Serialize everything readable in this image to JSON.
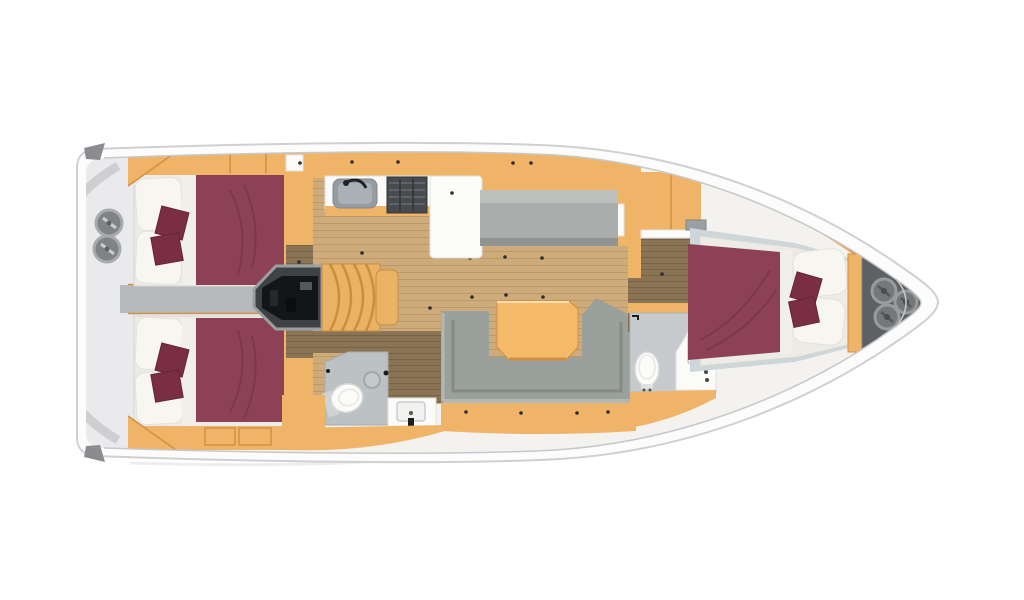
{
  "image": {
    "kind": "yacht-interior-floorplan",
    "orientation": "bow-right-stern-left",
    "visible_text": "",
    "rooms": [
      {
        "id": "aft-cabin-port",
        "contents": [
          "double-bed",
          "pillows-2",
          "cushions-2",
          "wardrobe"
        ]
      },
      {
        "id": "aft-cabin-starboard",
        "contents": [
          "double-bed",
          "pillows-2",
          "cushions-2",
          "wardrobe"
        ]
      },
      {
        "id": "engine-compartment",
        "contents": [
          "engine"
        ]
      },
      {
        "id": "companionway",
        "contents": [
          "curved-stairs"
        ]
      },
      {
        "id": "galley",
        "contents": [
          "sink",
          "stove",
          "counter",
          "fridge-peninsula"
        ]
      },
      {
        "id": "salon",
        "contents": [
          "straight-settee",
          "u-shaped-sofa",
          "table"
        ]
      },
      {
        "id": "aft-head",
        "contents": [
          "toilet",
          "vanity-sink",
          "drain"
        ]
      },
      {
        "id": "forward-head",
        "contents": [
          "toilet",
          "vanity-sink"
        ]
      },
      {
        "id": "forward-cabin",
        "contents": [
          "double-bed",
          "pillows-2",
          "cushions-2",
          "wardrobe",
          "vent"
        ]
      },
      {
        "id": "stern-deck",
        "contents": [
          "winch",
          "winch"
        ]
      },
      {
        "id": "anchor-locker",
        "contents": [
          "cleat",
          "cleat",
          "cleat"
        ]
      }
    ],
    "counts": {
      "cabins": 3,
      "heads": 2,
      "winches": 2,
      "bow_cleats": 3
    }
  },
  "palette": {
    "hull": "#fcfcfd",
    "hull_line": "#d0d0d2",
    "deck_line": "#c8c8ca",
    "stern_gray": "#eaeaec",
    "arc_gray": "#cfcfd1",
    "corner_wedge": "#8a8c8f",
    "walkway_gray": "#b7babd",
    "cream": "#f3f2ef",
    "wood_orange": "#f0b469",
    "wood_orange_dark": "#d28f41",
    "wood_floor": "#cdab7b",
    "wood_floor_line": "#bd9765",
    "wood_dark": "#8a7454",
    "wood_dark_line": "#766246",
    "burgundy": "#8d4156",
    "burgundy_crease": "#7b3447",
    "burgundy_dark": "#7a2e43",
    "mattress": "#ecebe5",
    "pillow": "#f8f6f1",
    "sofa_gray": "#9aa09b",
    "sofa_light": "#b3b8b4",
    "sofa_dark": "#858a86",
    "bench_gray": "#a9aeac",
    "bath_floor": "#bcc1c4",
    "fwd_bath_floor": "#c6cacd",
    "fwd_deck": "#cdd6d9",
    "fixture_white": "#fbfbfa",
    "steel_gray": "#969da2",
    "stove_dark": "#474b4e",
    "engine_box": "#3f4245",
    "engine_black": "#141517",
    "stairs_wood": "#eab265",
    "stairs_line": "#c98f3f",
    "table_orange": "#f4ba6a",
    "locker_gray": "#5d6163",
    "cleat_gray": "#747879",
    "dot_dark": "#2e2e2e"
  }
}
